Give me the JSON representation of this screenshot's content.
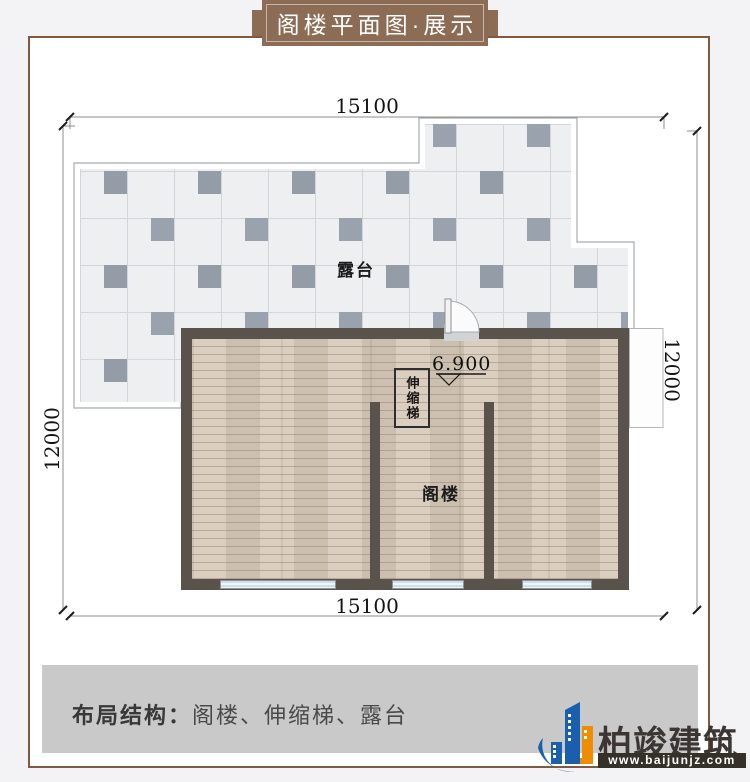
{
  "banner": {
    "title": "阁楼平面图·展示"
  },
  "dims": {
    "top": "15100",
    "bottom": "15100",
    "left": "12000",
    "right": "12000"
  },
  "plan": {
    "terrace_label": "露台",
    "attic_label": "阁楼",
    "ladder_label": "伸缩梯",
    "elevation": "6.900"
  },
  "footer": {
    "structure_label": "布局结构：",
    "structure_value": "阁楼、伸缩梯、露台"
  },
  "brand": {
    "name": "柏竣建筑",
    "url": "www.baijunjz.com"
  },
  "colors": {
    "ribbon_brown": "#8c6c55",
    "frame_brown": "#7d5a41",
    "wall_dark": "#59534b",
    "wood_floor": "#d6c9b9",
    "tile_light": "#edeff1",
    "tile_dark": "#939ca7",
    "footer_band_gray": "#c9c9c9",
    "brand_blue": "#1a5fae",
    "brand_orange": "#f08c00"
  }
}
